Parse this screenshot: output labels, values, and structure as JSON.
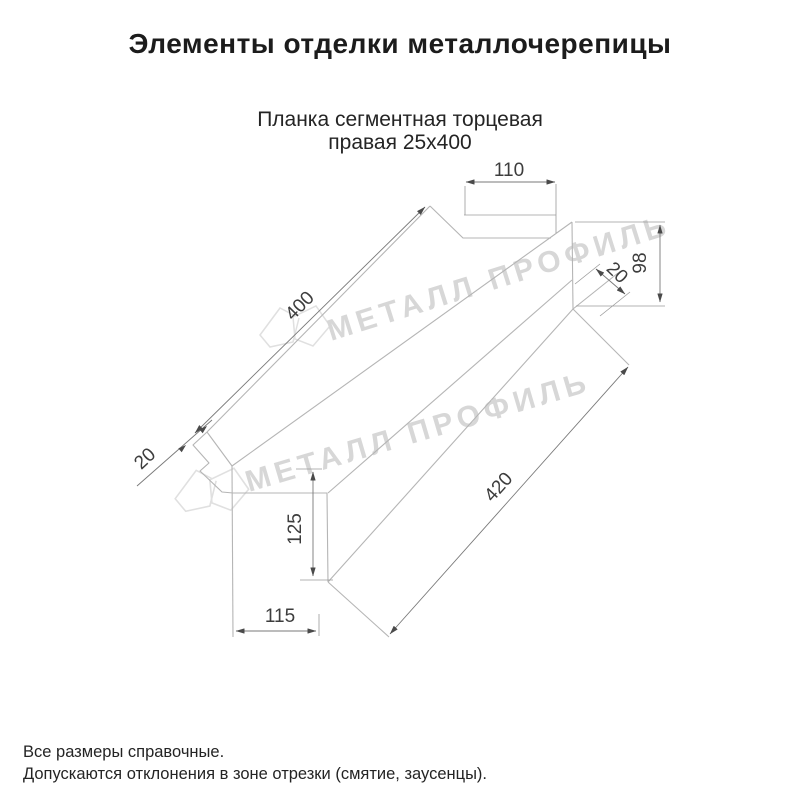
{
  "header": {
    "title": "Элементы отделки металлочерепицы"
  },
  "drawing": {
    "subtitle_line1": "Планка сегментная торцевая",
    "subtitle_line2": "правая 25х400",
    "dimensions": {
      "end_top_width": "110",
      "end_right_height": "98",
      "hem_right": "20",
      "top_edge_length": "400",
      "hem_left": "20",
      "end_left_height": "125",
      "end_bottom_width": "115",
      "bottom_edge_length": "420"
    },
    "watermark": {
      "text": "МЕТАЛЛ ПРОФИЛЬ",
      "color": "#d7d7d7"
    }
  },
  "footer": {
    "line1": "Все размеры справочные.",
    "line2": "Допускаются отклонения в зоне отрезки (смятие, заусенцы)."
  },
  "colors": {
    "text": "#1c1c1c",
    "dimension_text": "#3d3d3d",
    "shape_line": "#b5b5b5",
    "dimension_line": "#787878",
    "watermark": "#d7d7d7"
  }
}
